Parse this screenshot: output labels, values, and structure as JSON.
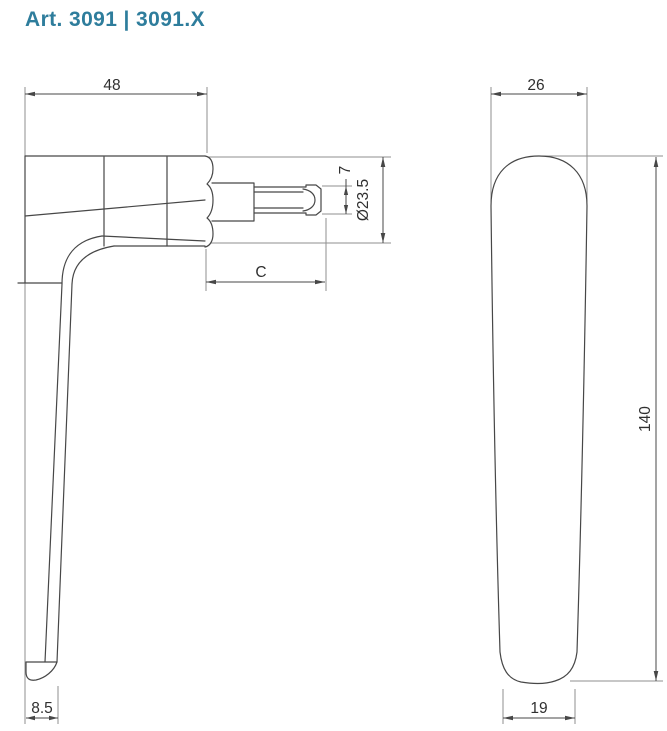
{
  "title": "Art. 3091 | 3091.X",
  "views": {
    "side": {
      "name": "handle side view",
      "dims": {
        "head_width": "48",
        "spindle_square": "7",
        "neck_diameter": "Ø23.5",
        "spindle_length": "C",
        "tip_depth": "8.5"
      }
    },
    "front": {
      "name": "handle front view",
      "dims": {
        "grip_width": "26",
        "grip_length": "140",
        "tip_width": "19"
      }
    }
  },
  "colors": {
    "accent": "#2e7d9c",
    "object_line": "#474747",
    "extension_line": "#8f8f8f",
    "dim_text": "#303030",
    "background": "#ffffff"
  }
}
